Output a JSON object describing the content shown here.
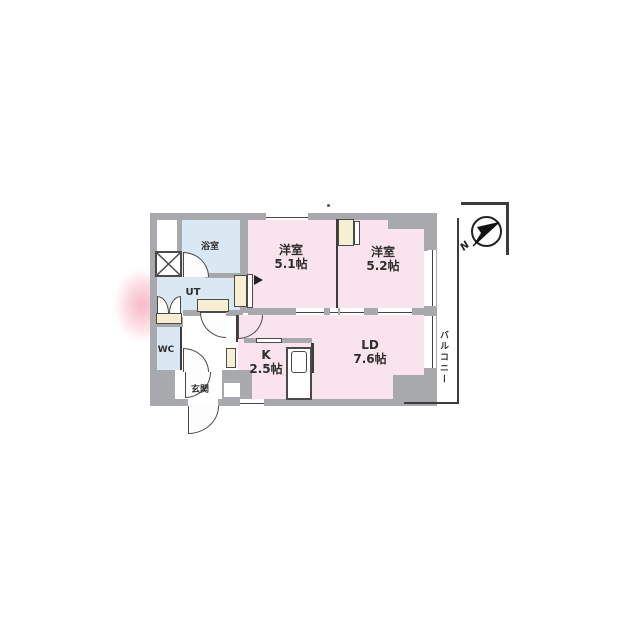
{
  "floorplan": {
    "rooms": [
      {
        "id": "bedroom-1",
        "label": "洋室",
        "size": "5.1帖"
      },
      {
        "id": "bedroom-2",
        "label": "洋室",
        "size": "5.2帖"
      },
      {
        "id": "living-dining",
        "label": "LD",
        "size": "7.6帖"
      },
      {
        "id": "kitchen",
        "label": "K",
        "size": "2.5帖"
      },
      {
        "id": "bath",
        "label": "浴室"
      },
      {
        "id": "utility",
        "label": "UT"
      },
      {
        "id": "toilet",
        "label": "WC"
      },
      {
        "id": "entrance",
        "label": "玄関"
      },
      {
        "id": "balcony",
        "label": "バルコニー"
      }
    ],
    "compass": {
      "label": "N"
    },
    "colors": {
      "room_pink": "#f9e3ec",
      "wet_area_blue": "#d9e8f3",
      "wall_gray": "#a7a9ac",
      "fixture_cream": "#f6efd2",
      "line_dark": "#3c3c3c"
    }
  }
}
